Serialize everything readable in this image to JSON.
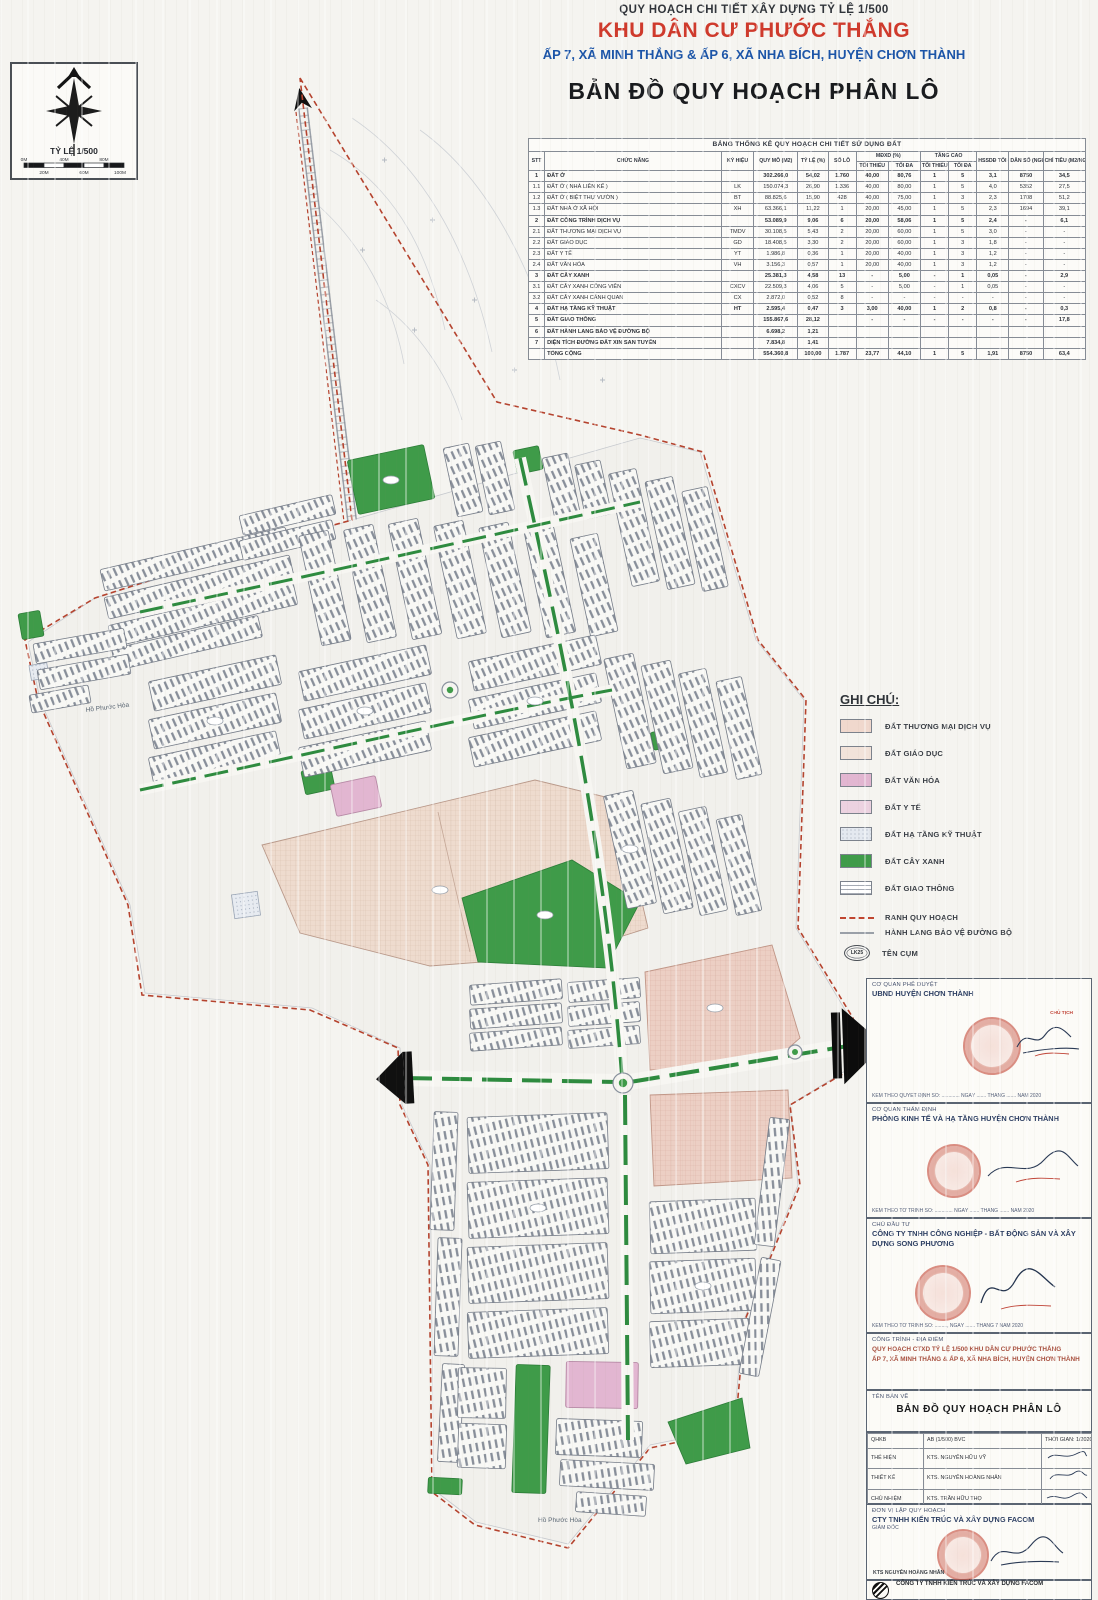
{
  "header": {
    "line1": "QUY HOẠCH CHI TIẾT XÂY DỰNG TỶ LỆ 1/500",
    "line2": "KHU DÂN CƯ PHƯỚC THẮNG",
    "line3": "ẤP 7, XÃ MINH THẮNG & ẤP 6, XÃ NHA BÍCH, HUYỆN CHƠN THÀNH",
    "line4": "BẢN ĐỒ QUY HOẠCH PHÂN LÔ"
  },
  "compass": {
    "scale_label": "TỶ LỆ 1/500",
    "ticks_top": [
      "0M",
      "40M",
      "80M"
    ],
    "ticks_bottom": [
      "20M",
      "60M",
      "100M"
    ]
  },
  "stats_table": {
    "title": "BẢNG THỐNG KÊ QUY HOẠCH CHI TIẾT SỬ DỤNG ĐẤT",
    "columns": {
      "stt": "STT",
      "chuc_nang": "CHỨC NĂNG",
      "ky_hieu": "KÝ HIỆU",
      "quy_mo": "QUY MÔ (M2)",
      "ty_le": "TỶ LỆ (%)",
      "so_lo": "SỐ LÔ",
      "mdxd": "MĐXD (%)",
      "tang_cao": "TẦNG CAO",
      "toi_thieu": "TỐI THIỂU",
      "toi_da": "TỐI ĐA",
      "hssdd": "HSSDĐ TỐI ĐA",
      "dan_so": "DÂN SỐ (NGƯỜI)",
      "chi_tieu": "CHỈ TIÊU (M2/NGƯỜI)"
    },
    "rows": [
      {
        "b": true,
        "c": [
          "1",
          "ĐẤT Ở",
          "",
          "302.266,0",
          "54,02",
          "1.760",
          "40,00",
          "80,76",
          "1",
          "5",
          "3,1",
          "8750",
          "34,5"
        ]
      },
      {
        "b": false,
        "c": [
          "1.1",
          "ĐẤT Ở ( NHÀ LIÊN KẾ )",
          "LK",
          "150.074,3",
          "26,90",
          "1.336",
          "40,00",
          "80,00",
          "1",
          "5",
          "4,0",
          "5352",
          "27,5"
        ]
      },
      {
        "b": false,
        "c": [
          "1.2",
          "ĐẤT Ở ( BIỆT THỰ VƯỜN )",
          "BT",
          "88.825,6",
          "15,90",
          "428",
          "40,00",
          "75,00",
          "1",
          "3",
          "2,3",
          "1708",
          "51,2"
        ]
      },
      {
        "b": false,
        "c": [
          "1.3",
          "ĐẤT NHÀ Ở XÃ HỘI",
          "XH",
          "63.366,1",
          "11,22",
          "1",
          "20,00",
          "45,00",
          "1",
          "5",
          "2,3",
          "1694",
          "39,1"
        ]
      },
      {
        "b": true,
        "c": [
          "2",
          "ĐẤT CÔNG TRÌNH DỊCH VỤ",
          "",
          "53.089,9",
          "9,06",
          "6",
          "20,00",
          "58,06",
          "1",
          "5",
          "2,4",
          "-",
          "6,1"
        ]
      },
      {
        "b": false,
        "c": [
          "2.1",
          "ĐẤT THƯƠNG MẠI DỊCH VỤ",
          "TMDV",
          "30.108,5",
          "5,43",
          "2",
          "20,00",
          "60,00",
          "1",
          "5",
          "3,0",
          "-",
          "-"
        ]
      },
      {
        "b": false,
        "c": [
          "2.2",
          "ĐẤT GIÁO DỤC",
          "GD",
          "18.408,5",
          "3,30",
          "2",
          "20,00",
          "60,00",
          "1",
          "3",
          "1,8",
          "-",
          "-"
        ]
      },
      {
        "b": false,
        "c": [
          "2.3",
          "ĐẤT Y TẾ",
          "YT",
          "1.986,8",
          "0,36",
          "1",
          "20,00",
          "40,00",
          "1",
          "3",
          "1,2",
          "-",
          "-"
        ]
      },
      {
        "b": false,
        "c": [
          "2.4",
          "ĐẤT VĂN HÓA",
          "VH",
          "3.156,3",
          "0,57",
          "1",
          "20,00",
          "40,00",
          "1",
          "3",
          "1,2",
          "-",
          "-"
        ]
      },
      {
        "b": true,
        "c": [
          "3",
          "ĐẤT CÂY XANH",
          "",
          "25.381,3",
          "4,58",
          "13",
          "-",
          "5,00",
          "-",
          "1",
          "0,05",
          "-",
          "2,9"
        ]
      },
      {
        "b": false,
        "c": [
          "3.1",
          "ĐẤT CÂY XANH CÔNG VIÊN",
          "CXCV",
          "22.509,3",
          "4,06",
          "5",
          "-",
          "5,00",
          "-",
          "1",
          "0,05",
          "-",
          "-"
        ]
      },
      {
        "b": false,
        "c": [
          "3.2",
          "ĐẤT CÂY XANH CẢNH QUAN",
          "CX",
          "2.872,0",
          "0,52",
          "8",
          "-",
          "-",
          "-",
          "-",
          "-",
          "-",
          "-"
        ]
      },
      {
        "b": true,
        "c": [
          "4",
          "ĐẤT HẠ TẦNG KỸ THUẬT",
          "HT",
          "2.595,4",
          "0,47",
          "3",
          "3,00",
          "40,00",
          "1",
          "2",
          "0,8",
          "-",
          "0,3"
        ]
      },
      {
        "b": true,
        "c": [
          "5",
          "ĐẤT GIAO THÔNG",
          "",
          "155.867,6",
          "28,12",
          "",
          "-",
          "-",
          "-",
          "-",
          "-",
          "-",
          "17,8"
        ]
      },
      {
        "b": true,
        "c": [
          "6",
          "ĐẤT HÀNH LANG BẢO VỆ ĐƯỜNG BỘ",
          "",
          "6.698,2",
          "1,21",
          "",
          "",
          "",
          "",
          "",
          "",
          "",
          ""
        ]
      },
      {
        "b": true,
        "c": [
          "7",
          "DIỆN TÍCH ĐƯỜNG ĐẤT XIN SAN TUYẾN",
          "",
          "7.834,8",
          "1,41",
          "",
          "",
          "",
          "",
          "",
          "",
          "",
          ""
        ]
      },
      {
        "b": true,
        "c": [
          "",
          "TỔNG CỘNG",
          "",
          "554.360,8",
          "100,00",
          "1.787",
          "23,77",
          "44,10",
          "1",
          "5",
          "1,91",
          "8750",
          "63,4"
        ]
      }
    ]
  },
  "legend": {
    "title": "GHI CHÚ:",
    "items": [
      {
        "label": "ĐẤT THƯƠNG MẠI DỊCH VỤ",
        "color": "#f0d8cd"
      },
      {
        "label": "ĐẤT GIÁO DỤC",
        "color": "#f2e3da"
      },
      {
        "label": "ĐẤT VĂN HÓA",
        "color": "#e2b6d1"
      },
      {
        "label": "ĐẤT Y TẾ",
        "color": "#ecd2e0"
      },
      {
        "label": "ĐẤT HẠ TẦNG KỸ THUẬT",
        "color": "#e4e9f0"
      },
      {
        "label": "ĐẤT CÂY XANH",
        "color": "#3f9b49"
      },
      {
        "label": "ĐẤT GIAO THÔNG",
        "color": "#ffffff"
      }
    ],
    "lines": [
      {
        "label": "RANH QUY HOẠCH",
        "color": "#c0452f"
      },
      {
        "label": "HÀNH LANG BẢO VỆ ĐƯỜNG BỘ",
        "color": "#9aa0a8"
      }
    ],
    "cluster": {
      "label": "TÊN CỤM",
      "badge": "LK25"
    }
  },
  "map": {
    "lake_label_1": "Hồ Phước Hòa",
    "lake_label_2": "Hồ Phước Hòa"
  },
  "title_block": {
    "approval": {
      "role": "CƠ QUAN PHÊ DUYỆT",
      "org": "UBND HUYỆN CHƠN THÀNH",
      "stamp_note": "CHỦ TỊCH",
      "footer": "KÈM THEO QUYẾT ĐỊNH SỐ: ............. NGÀY ....... THÁNG ....... NĂM 2020"
    },
    "appraisal": {
      "role": "CƠ QUAN THẨM ĐỊNH",
      "org": "PHÒNG KINH TẾ VÀ HẠ TẦNG HUYỆN CHƠN THÀNH",
      "footer": "KÈM THEO TỜ TRÌNH SỐ: ............. NGÀY ....... THÁNG ....... NĂM 2020"
    },
    "investor": {
      "role": "CHỦ ĐẦU TƯ",
      "org": "CÔNG TY TNHH CÔNG NGHIỆP - BẤT ĐỘNG SẢN VÀ XÂY DỰNG SONG PHƯƠNG",
      "footer": "KÈM THEO TỜ TRÌNH SỐ: ........., NGÀY ....... THÁNG 7 NĂM 2020"
    },
    "project": {
      "role": "CÔNG TRÌNH - ĐỊA ĐIỂM",
      "line1": "QUY HOẠCH CTXD TỶ LỆ 1/500 KHU DÂN CƯ PHƯỚC THẮNG",
      "line2": "ẤP 7, XÃ MINH THẮNG & ẤP 6, XÃ NHA BÍCH, HUYỆN CHƠN THÀNH"
    },
    "drawing": {
      "role": "TÊN BẢN VẼ",
      "name": "BẢN ĐỒ QUY HOẠCH PHÂN LÔ"
    },
    "crew": {
      "meta_label": "QHKB",
      "meta_value": "AB (1/500) BVC",
      "meta_right": "THỜI GIAN: 1/2020",
      "rows": [
        {
          "role": "THỂ HIỆN",
          "name": "KTS. NGUYỄN HỮU VỸ"
        },
        {
          "role": "THIẾT KẾ",
          "name": "KTS. NGUYỄN HOÀNG NHÂN"
        },
        {
          "role": "CHỦ NHIỆM",
          "name": "KTS. TRẦN HỮU THỌ"
        },
        {
          "role": "QL KỸ THUẬT",
          "name": "KS. TIẾN MINH"
        }
      ]
    },
    "planner": {
      "role": "ĐƠN VỊ LẬP QUY HOẠCH",
      "org": "CTY TNHH KIẾN TRÚC VÀ XÂY DỰNG FACOM",
      "sub": "GIÁM ĐỐC",
      "name": "KTS NGUYỄN HOÀNG NHÂN"
    },
    "footer_company": {
      "name": "CÔNG TY TNHH KIẾN TRÚC VÀ XÂY DỰNG FACOM"
    }
  },
  "colors": {
    "boundary": "#b5432e",
    "green": "#3f9b49",
    "commercial": "#eccfc4",
    "education": "#eedbce",
    "culture": "#e2b6d1",
    "medical": "#ecd2e0",
    "infrastructure": "#e7ebf1",
    "title_red": "#cf3a2c",
    "title_blue": "#1c55a8"
  }
}
